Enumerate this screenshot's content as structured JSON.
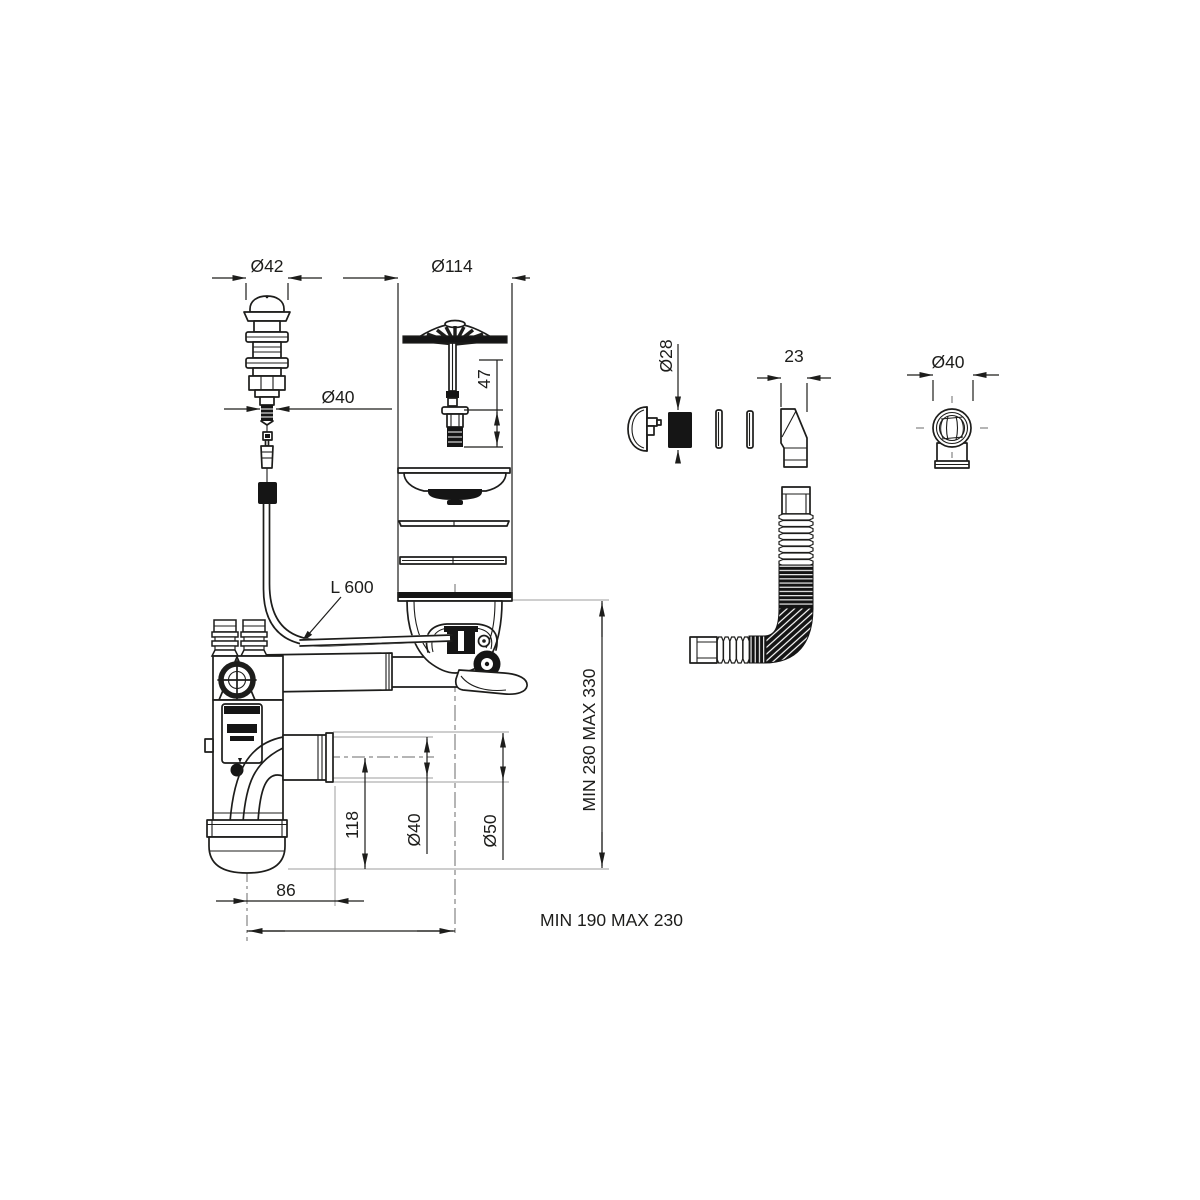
{
  "canvas": {
    "background": "#ffffff",
    "ink_color": "#1d1d1b",
    "reference_line_color": "#9d9d9c"
  },
  "labels": {
    "knob_cap_diameter": "Ø42",
    "knob_tail_diameter": "Ø40",
    "strainer_diameter": "Ø114",
    "locking_bolt_height": "47",
    "overflow_bushing_diameter": "Ø28",
    "overflow_nozzle_width": "23",
    "elbow_outlet_diameter": "Ø40",
    "control_cable_length": "L 600",
    "outlet_drop_height": "118",
    "waste_pipe_diameter": "Ø40",
    "waste_pipe_end_diameter": "Ø50",
    "trap_cup_offset": "86",
    "horizontal_adjust_range": "MIN 190 MAX 230",
    "vertical_adjust_range": "MIN 280 MAX 330"
  }
}
